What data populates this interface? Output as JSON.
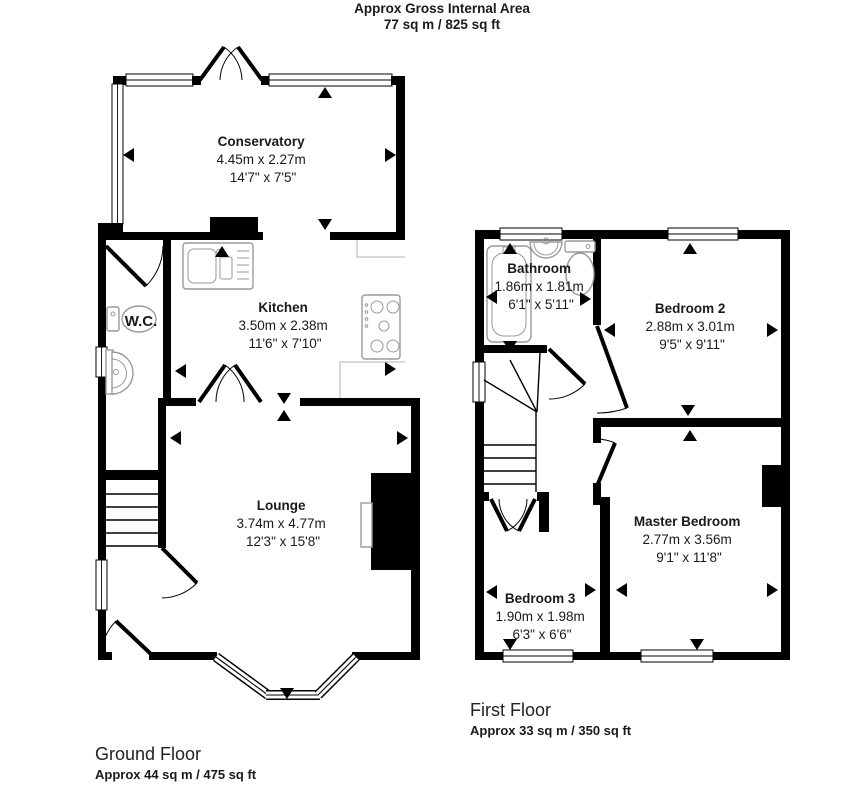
{
  "header": {
    "title": "Approx Gross Internal Area",
    "subtitle": "77 sq m / 825 sq ft"
  },
  "ground_floor": {
    "caption": "Ground Floor",
    "area": "Approx 44 sq m / 475 sq ft",
    "rooms": {
      "conservatory": {
        "name": "Conservatory",
        "metric": "4.45m x 2.27m",
        "imperial": "14'7\" x 7'5\""
      },
      "kitchen": {
        "name": "Kitchen",
        "metric": "3.50m x 2.38m",
        "imperial": "11'6\" x 7'10\""
      },
      "wc": {
        "name": "W.C."
      },
      "lounge": {
        "name": "Lounge",
        "metric": "3.74m x 4.77m",
        "imperial": "12'3\" x 15'8\""
      }
    }
  },
  "first_floor": {
    "caption": "First Floor",
    "area": "Approx 33 sq m / 350 sq ft",
    "rooms": {
      "bathroom": {
        "name": "Bathroom",
        "metric": "1.86m x 1.81m",
        "imperial": "6'1\" x 5'11\""
      },
      "bedroom2": {
        "name": "Bedroom 2",
        "metric": "2.88m x 3.01m",
        "imperial": "9'5\" x 9'11\""
      },
      "master_bedroom": {
        "name": "Master Bedroom",
        "metric": "2.77m x 3.56m",
        "imperial": "9'1\" x 11'8\""
      },
      "bedroom3": {
        "name": "Bedroom 3",
        "metric": "1.90m x 1.98m",
        "imperial": "6'3\" x 6'6\""
      }
    }
  },
  "colors": {
    "wall": "#000000",
    "background": "#ffffff",
    "fixture_outline": "#9a9a9a"
  }
}
